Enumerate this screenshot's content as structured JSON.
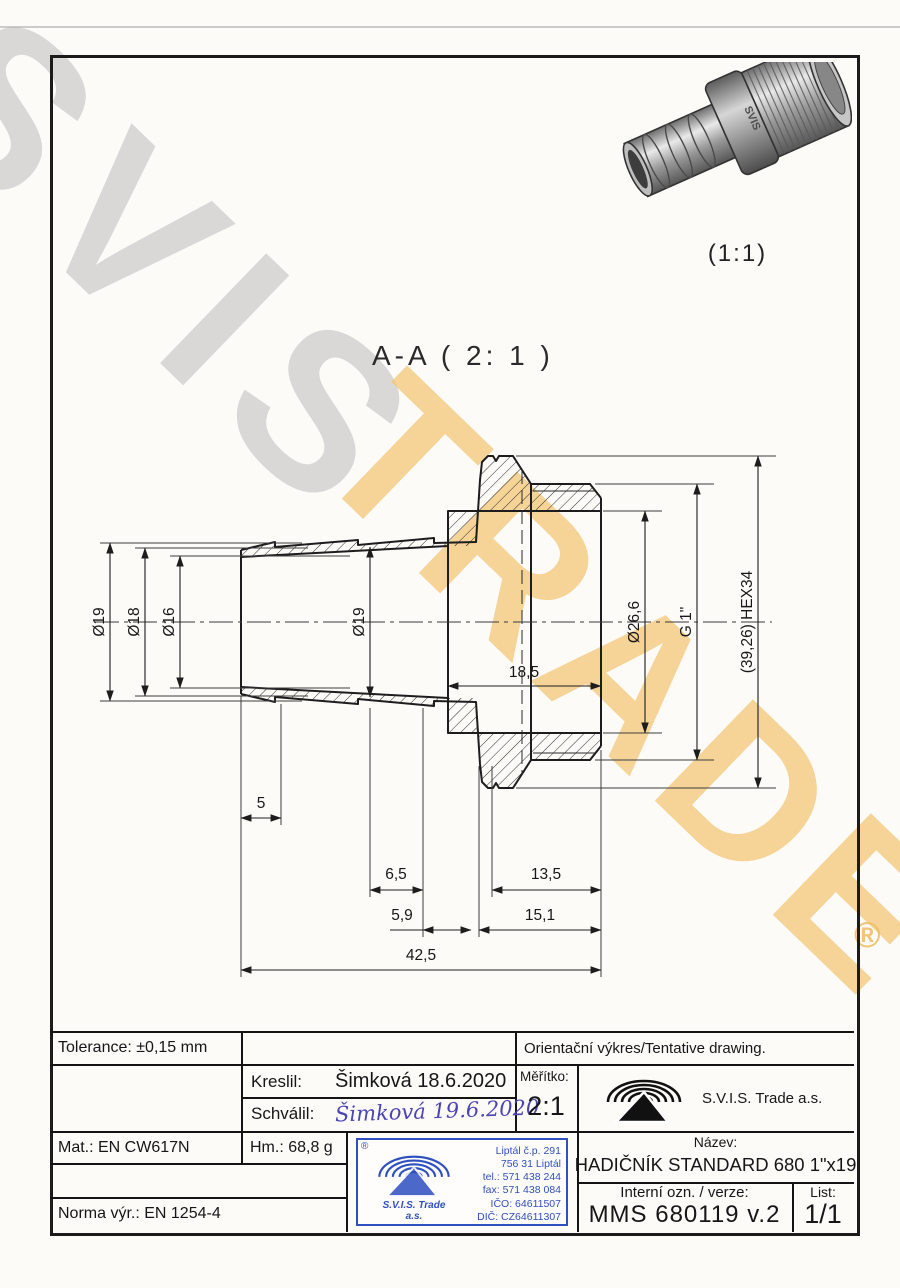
{
  "watermark": {
    "word1": "SVIS",
    "word2": "TRADE",
    "registered": "®"
  },
  "model_3d": {
    "brand_engraving": "SVIS",
    "scale_label": "(1:1)"
  },
  "section_view": {
    "title": "A-A ( 2: 1 )",
    "dimensions": {
      "dia19_left": "Ø19",
      "dia18": "Ø18",
      "dia16": "Ø16",
      "dia19_bore": "Ø19",
      "dia26_6": "Ø26,6",
      "thread": "G 1\"",
      "hex": "(39,26) HEX34",
      "len18_5": "18,5",
      "len5": "5",
      "len6_5": "6,5",
      "len13_5": "13,5",
      "len5_9": "5,9",
      "len15_1": "15,1",
      "len42_5": "42,5"
    }
  },
  "title_block": {
    "tolerance": "Tolerance: ±0,15 mm",
    "orientation_note": "Orientační výkres/Tentative drawing.",
    "kreslil_label": "Kreslil:",
    "kreslil_value": "Šimková 18.6.2020",
    "schvalil_label": "Schválil:",
    "schvalil_signature": "Šimková 19.6.2020",
    "meritko_label": "Měřítko:",
    "meritko_value": "2:1",
    "company": "S.V.I.S. Trade a.s.",
    "mat": "Mat.: EN CW617N",
    "hm": "Hm.: 68,8 g",
    "norma": "Norma výr.: EN 1254-4",
    "nazev_label": "Název:",
    "nazev_value": "HADIČNÍK STANDARD 680 1\"x19",
    "interni_label": "Interní ozn. / verze:",
    "interni_value": "MMS 680119 v.2",
    "list_label": "List:",
    "list_value": "1/1"
  },
  "stamp": {
    "registered": "®",
    "company_line1": "S.V.I.S. Trade",
    "company_line2": "a.s.",
    "address1": "Liptál č.p. 291",
    "address2": "756 31 Liptál",
    "tel": "tel.: 571 438 244",
    "fax": "fax: 571 438 084",
    "ico": "IČO: 64611507",
    "dic": "DIČ: CZ64611307"
  },
  "colors": {
    "stamp_blue": "#2e4fc0",
    "watermark_yellow": "#f6c973",
    "watermark_gray": "#d6d6d6"
  }
}
